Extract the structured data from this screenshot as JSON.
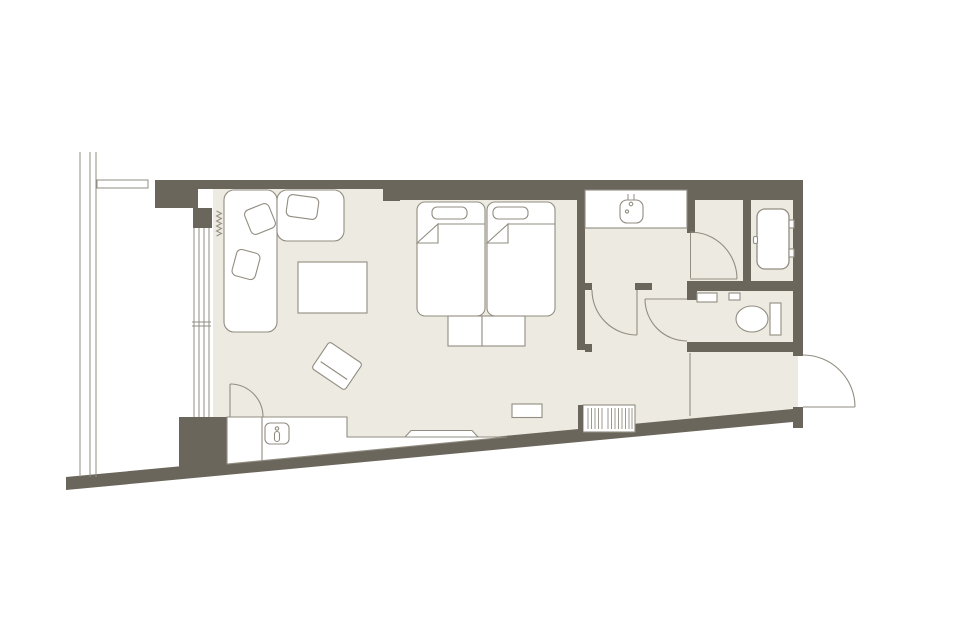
{
  "canvas": {
    "width": 960,
    "height": 640,
    "background": "#ffffff"
  },
  "palette": {
    "wall": "#6b665b",
    "floor": "#edeae1",
    "white": "#ffffff",
    "line": "#928d81"
  },
  "plan": {
    "shapes": [
      {
        "name": "floor-area",
        "k": "poly",
        "p": "200,189 798,189 798,412 200,468",
        "f": "floor"
      },
      {
        "name": "window-bay",
        "k": "rect",
        "x": 193,
        "y": 189,
        "w": 20,
        "h": 280,
        "f": "white"
      },
      {
        "name": "wall-top-living",
        "k": "rect",
        "x": 155,
        "y": 180,
        "w": 228,
        "h": 9,
        "f": "wall"
      },
      {
        "name": "wall-top-column",
        "k": "rect",
        "x": 383,
        "y": 180,
        "w": 17,
        "h": 21,
        "f": "wall"
      },
      {
        "name": "wall-top-beds",
        "k": "rect",
        "x": 400,
        "y": 180,
        "w": 177,
        "h": 20,
        "f": "wall"
      },
      {
        "name": "wall-top-washroom",
        "k": "rect",
        "x": 577,
        "y": 180,
        "w": 113,
        "h": 10,
        "f": "wall"
      },
      {
        "name": "wall-top-bathroom",
        "k": "rect",
        "x": 690,
        "y": 180,
        "w": 113,
        "h": 20,
        "f": "wall"
      },
      {
        "name": "wall-right-outer",
        "k": "rect",
        "x": 793,
        "y": 180,
        "w": 10,
        "h": 176,
        "f": "wall"
      },
      {
        "name": "wall-left-upper",
        "k": "rect",
        "x": 155,
        "y": 180,
        "w": 43,
        "h": 28,
        "f": "wall"
      },
      {
        "name": "wall-left-step",
        "k": "rect",
        "x": 193,
        "y": 208,
        "w": 19,
        "h": 20,
        "f": "wall"
      },
      {
        "name": "wall-window-lower",
        "k": "rect",
        "x": 179,
        "y": 417,
        "w": 48,
        "h": 57,
        "f": "wall"
      },
      {
        "name": "wall-bottom-diagonal",
        "k": "poly",
        "p": "66,477 803,408 803,421 66,490",
        "f": "wall"
      },
      {
        "name": "wall-entry-corner",
        "k": "rect",
        "x": 793,
        "y": 407,
        "w": 10,
        "h": 21,
        "f": "wall"
      },
      {
        "name": "wall-washroom-divider",
        "k": "rect",
        "x": 577,
        "y": 189,
        "w": 8,
        "h": 161,
        "f": "wall"
      },
      {
        "name": "wall-vanity-stub-left",
        "k": "rect",
        "x": 585,
        "y": 283,
        "w": 7,
        "h": 7,
        "f": "wall"
      },
      {
        "name": "wall-vanity-stub-right",
        "k": "rect",
        "x": 635,
        "y": 283,
        "w": 17,
        "h": 7,
        "f": "wall"
      },
      {
        "name": "wall-hall-stub",
        "k": "rect",
        "x": 585,
        "y": 344,
        "w": 7,
        "h": 8,
        "f": "wall"
      },
      {
        "name": "wall-partition",
        "k": "rect",
        "x": 687,
        "y": 189,
        "w": 8,
        "h": 44,
        "f": "wall"
      },
      {
        "name": "wall-tub-door-panel",
        "k": "rect",
        "x": 743,
        "y": 200,
        "w": 8,
        "h": 81,
        "f": "wall"
      },
      {
        "name": "wall-bath-band",
        "k": "rect",
        "x": 687,
        "y": 281,
        "w": 116,
        "h": 10,
        "f": "wall"
      },
      {
        "name": "wall-wc-stub",
        "k": "rect",
        "x": 687,
        "y": 290,
        "w": 10,
        "h": 10,
        "f": "wall"
      },
      {
        "name": "wall-wc-bottom",
        "k": "rect",
        "x": 687,
        "y": 342,
        "w": 116,
        "h": 10,
        "f": "wall"
      },
      {
        "name": "balcony-railing",
        "k": "ml",
        "seg": [
          [
            80,
            152,
            80,
            477
          ],
          [
            90,
            152,
            90,
            477
          ],
          [
            96,
            152,
            96,
            477
          ]
        ],
        "s": "line",
        "sw": 1
      },
      {
        "name": "balcony-divider",
        "k": "rect",
        "x": 97,
        "y": 180,
        "w": 51,
        "h": 8,
        "f": "white",
        "s": "line",
        "sw": 1
      },
      {
        "name": "window-glass-lines",
        "k": "ml",
        "seg": [
          [
            194,
            228,
            194,
            417
          ],
          [
            199,
            228,
            199,
            417
          ],
          [
            204,
            228,
            204,
            417
          ],
          [
            209,
            228,
            209,
            417
          ]
        ],
        "s": "line",
        "sw": 1
      },
      {
        "name": "window-mullion",
        "k": "ml",
        "seg": [
          [
            192,
            322,
            211,
            322
          ],
          [
            192,
            326,
            211,
            326
          ]
        ],
        "s": "line",
        "sw": 1
      },
      {
        "name": "curtain-symbol",
        "k": "polyline",
        "p": "216.5,211 221.5,213.5 216.5,216 221.5,218.5 216.5,221 221.5,223.5 216.5,226 221.5,228.5 216.5,231 221.5,233.5 216.5,236",
        "s": "line",
        "sw": 1
      },
      {
        "name": "counter",
        "k": "poly",
        "p": "227,417 347,417 347,437 507,437 227,464",
        "f": "white",
        "s": "line"
      },
      {
        "name": "counter-divider",
        "k": "line",
        "x1": 262,
        "y1": 417,
        "x2": 262,
        "y2": 461,
        "s": "line"
      },
      {
        "name": "minibar-sink",
        "k": "rect",
        "x": 265,
        "y": 423,
        "w": 24,
        "h": 21,
        "r": 5,
        "f": "white",
        "s": "line"
      },
      {
        "name": "minibar-faucet-dot",
        "k": "circle",
        "cx": 277,
        "cy": 428.5,
        "r": 1.7,
        "s": "line"
      },
      {
        "name": "minibar-faucet-lever",
        "k": "rect",
        "x": 274.5,
        "y": 431.5,
        "w": 5,
        "h": 10,
        "r": 2.5,
        "s": "line"
      },
      {
        "name": "tv",
        "k": "poly",
        "p": "405,437 411,430.5 472,430.5 478,437",
        "f": "white",
        "s": "line"
      },
      {
        "name": "entry-bench",
        "k": "rect",
        "x": 512,
        "y": 404,
        "w": 30,
        "h": 13.5,
        "f": "white",
        "s": "line"
      },
      {
        "name": "luggage-rack",
        "k": "rect",
        "x": 583,
        "y": 405,
        "w": 52,
        "h": 27,
        "f": "white",
        "s": "line"
      },
      {
        "name": "luggage-rack-hatch",
        "k": "ml",
        "seg": [
          [
            588,
            408,
            588,
            429
          ],
          [
            591.5,
            408,
            591.5,
            429
          ],
          [
            595,
            408,
            595,
            429
          ],
          [
            598.5,
            408,
            598.5,
            429
          ],
          [
            602,
            408,
            602,
            429
          ],
          [
            608,
            408,
            608,
            429
          ],
          [
            611.5,
            408,
            611.5,
            429
          ],
          [
            615,
            408,
            615,
            429
          ],
          [
            618.5,
            408,
            618.5,
            429
          ],
          [
            622,
            408,
            622,
            429
          ],
          [
            625.5,
            408,
            625.5,
            429
          ],
          [
            629,
            408,
            629,
            429
          ],
          [
            632,
            408,
            632,
            429
          ]
        ],
        "s": "line",
        "sw": 0.9
      },
      {
        "name": "entry-post",
        "k": "rect",
        "x": 578,
        "y": 405,
        "w": 5,
        "h": 28,
        "f": "wall"
      },
      {
        "name": "genkan-step-line",
        "k": "line",
        "x1": 690,
        "y1": 353,
        "x2": 690,
        "y2": 416,
        "s": "line"
      },
      {
        "name": "sofa-chaise",
        "k": "rect",
        "x": 224,
        "y": 190,
        "w": 53,
        "h": 142,
        "r": 10,
        "f": "white",
        "s": "line"
      },
      {
        "name": "sofa-section",
        "k": "rect",
        "x": 277,
        "y": 190,
        "w": 67,
        "h": 51,
        "r": 10,
        "f": "white",
        "s": "line"
      },
      {
        "name": "sofa-cushion-1",
        "k": "rect",
        "x": 234,
        "y": 251,
        "w": 24,
        "h": 27,
        "r": 5,
        "f": "white",
        "s": "line",
        "t": "rotate(15 246 264.5)"
      },
      {
        "name": "sofa-cushion-2",
        "k": "rect",
        "x": 247,
        "y": 206,
        "w": 26,
        "h": 26,
        "r": 5,
        "f": "white",
        "s": "line",
        "t": "rotate(-22 260 219)"
      },
      {
        "name": "sofa-cushion-3",
        "k": "rect",
        "x": 287,
        "y": 196,
        "w": 31,
        "h": 22,
        "r": 5,
        "f": "white",
        "s": "line",
        "t": "rotate(8 302.5 207)"
      },
      {
        "name": "coffee-table",
        "k": "rect",
        "x": 298,
        "y": 262,
        "w": 69,
        "h": 51,
        "f": "white",
        "s": "line"
      },
      {
        "name": "stool",
        "k": "rect",
        "x": 317,
        "y": 350,
        "w": 40,
        "h": 32,
        "r": 3,
        "f": "white",
        "s": "line",
        "t": "rotate(34 337 366)"
      },
      {
        "name": "stool-inner-line",
        "k": "line",
        "x1": 321,
        "y1": 371.5,
        "x2": 353,
        "y2": 371.5,
        "s": "line",
        "t": "rotate(34 337 366)"
      },
      {
        "name": "bed-1",
        "k": "rect",
        "x": 417,
        "y": 202,
        "w": 68,
        "h": 114,
        "r": 8,
        "f": "white",
        "s": "line"
      },
      {
        "name": "bed-1-pillow",
        "k": "rect",
        "x": 432,
        "y": 207,
        "w": 35,
        "h": 12,
        "r": 5,
        "f": "white",
        "s": "line"
      },
      {
        "name": "bed-1-sheet-line",
        "k": "line",
        "x1": 438,
        "y1": 224,
        "x2": 485,
        "y2": 224,
        "s": "line"
      },
      {
        "name": "bed-1-fold",
        "k": "poly",
        "p": "417,243 438,224 438,243",
        "f": "white",
        "s": "line"
      },
      {
        "name": "bed-2",
        "k": "rect",
        "x": 487,
        "y": 202,
        "w": 68,
        "h": 114,
        "r": 8,
        "f": "white",
        "s": "line"
      },
      {
        "name": "bed-2-pillow",
        "k": "rect",
        "x": 493,
        "y": 207,
        "w": 35,
        "h": 12,
        "r": 5,
        "f": "white",
        "s": "line"
      },
      {
        "name": "bed-2-sheet-line",
        "k": "line",
        "x1": 508,
        "y1": 224,
        "x2": 555,
        "y2": 224,
        "s": "line"
      },
      {
        "name": "bed-2-fold",
        "k": "poly",
        "p": "487,243 508,224 508,243",
        "f": "white",
        "s": "line"
      },
      {
        "name": "foot-bench-1",
        "k": "rect",
        "x": 448,
        "y": 316,
        "w": 34,
        "h": 30,
        "f": "white",
        "s": "line"
      },
      {
        "name": "foot-bench-2",
        "k": "rect",
        "x": 482,
        "y": 316,
        "w": 43,
        "h": 30,
        "f": "white",
        "s": "line"
      },
      {
        "name": "vanity-counter",
        "k": "rect",
        "x": 585,
        "y": 190,
        "w": 102,
        "h": 38,
        "f": "white",
        "s": "line"
      },
      {
        "name": "vanity-sink",
        "k": "rect",
        "x": 620,
        "y": 200,
        "w": 23,
        "h": 23,
        "r": 7,
        "f": "white",
        "s": "line"
      },
      {
        "name": "vanity-faucet",
        "k": "ml",
        "seg": [
          [
            628,
            194,
            628,
            200
          ],
          [
            634,
            194,
            634,
            200
          ]
        ],
        "s": "line",
        "sw": 1
      },
      {
        "name": "vanity-faucet-dot",
        "k": "circle",
        "cx": 631,
        "cy": 204,
        "r": 1.8,
        "s": "line"
      },
      {
        "name": "vanity-drain",
        "k": "circle",
        "cx": 627,
        "cy": 211.5,
        "r": 1.6,
        "s": "line"
      },
      {
        "name": "bathtub",
        "k": "rect",
        "x": 757,
        "y": 209,
        "w": 32,
        "h": 60,
        "r": 8,
        "f": "white",
        "s": "line",
        "sw": 1.3
      },
      {
        "name": "bathtub-ledge-1",
        "k": "rect",
        "x": 789,
        "y": 220,
        "w": 5,
        "h": 8,
        "f": "white",
        "s": "line"
      },
      {
        "name": "bathtub-ledge-2",
        "k": "rect",
        "x": 789,
        "y": 249,
        "w": 5,
        "h": 8,
        "f": "white",
        "s": "line"
      },
      {
        "name": "bathtub-grip",
        "k": "rect",
        "x": 753.5,
        "y": 236.5,
        "w": 4,
        "h": 7,
        "r": 1.5,
        "f": "white",
        "s": "line"
      },
      {
        "name": "toilet-tank",
        "k": "rect",
        "x": 770,
        "y": 303,
        "w": 11,
        "h": 32,
        "f": "white",
        "s": "line"
      },
      {
        "name": "toilet-bowl",
        "k": "ellipse",
        "cx": 752,
        "cy": 319,
        "rx": 16,
        "ry": 13,
        "f": "white",
        "s": "line"
      },
      {
        "name": "wc-shelf",
        "k": "rect",
        "x": 697,
        "y": 293,
        "w": 20,
        "h": 9,
        "f": "white",
        "s": "line"
      },
      {
        "name": "wc-control",
        "k": "rect",
        "x": 729,
        "y": 293,
        "w": 11,
        "h": 7,
        "f": "white",
        "s": "line"
      },
      {
        "name": "closet-door-leaf",
        "k": "line",
        "x1": 230,
        "y1": 384,
        "x2": 230,
        "y2": 417,
        "s": "line"
      },
      {
        "name": "closet-door-arc",
        "k": "path",
        "d": "M 230 384 A 33 33 0 0 1 263 417",
        "s": "line"
      },
      {
        "name": "washroom-door-leaf",
        "k": "line",
        "x1": 637,
        "y1": 290,
        "x2": 637,
        "y2": 335,
        "s": "line"
      },
      {
        "name": "washroom-door-arc",
        "k": "path",
        "d": "M 592 290 A 45 45 0 0 0 637 335",
        "s": "line"
      },
      {
        "name": "vestibule-door-jamb",
        "k": "line",
        "x1": 690.5,
        "y1": 233,
        "x2": 690.5,
        "y2": 278,
        "s": "line",
        "sw": 1
      },
      {
        "name": "vestibule-door-leaf",
        "k": "line",
        "x1": 690,
        "y1": 279,
        "x2": 737,
        "y2": 279,
        "s": "line"
      },
      {
        "name": "vestibule-door-arc",
        "k": "path",
        "d": "M 690 232 A 47 47 0 0 1 737 279",
        "s": "line"
      },
      {
        "name": "toilet-door-leaf",
        "k": "line",
        "x1": 645,
        "y1": 299,
        "x2": 687,
        "y2": 299,
        "s": "line"
      },
      {
        "name": "toilet-door-arc",
        "k": "path",
        "d": "M 645 299 A 42 42 0 0 0 687 341",
        "s": "line"
      },
      {
        "name": "entrance-door-leaf",
        "k": "line",
        "x1": 803,
        "y1": 407,
        "x2": 855,
        "y2": 407,
        "s": "line"
      },
      {
        "name": "entrance-door-arc",
        "k": "path",
        "d": "M 803 355 A 52 52 0 0 1 855 407",
        "s": "line"
      }
    ]
  }
}
